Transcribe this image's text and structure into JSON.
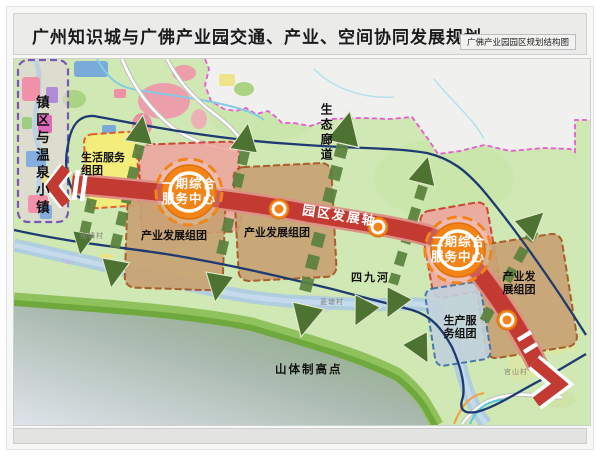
{
  "page": {
    "title": "广州知识城与广佛产业园交通、产业、空间协同发展规划",
    "subtitle": "广佛产业园园区规划结构图"
  },
  "map": {
    "town_zone_label": "镇区与温泉小镇",
    "life_cluster": {
      "line1": "生活服务",
      "line2": "组团"
    },
    "phase1_center": {
      "line1": "一期综合",
      "line2": "服务中心"
    },
    "phase2_center": {
      "line1": "二期综合",
      "line2": "服务中心"
    },
    "industry_cluster_1": "产业发展组团",
    "industry_cluster_2": "产业发展组团",
    "industry_cluster_3": {
      "line1": "产业发",
      "line2": "展组团"
    },
    "production_cluster": {
      "line1": "生产服",
      "line2": "务组团"
    },
    "axis_label": "园区发展轴",
    "eco_corridor_label": "生态廊道",
    "river_label": "四九河",
    "mountain_label": "山体制高点",
    "villages": {
      "v1": "细镇村",
      "v2": "菱塘村",
      "v3": "官山村"
    },
    "colors": {
      "axis_red": "#c23a32",
      "node_orange": "#f28418",
      "corridor_green": "#4d7231",
      "cluster_tan": "#c8a273",
      "life_yellow": "#f5ee78",
      "service_pink": "#efa39e",
      "production_blue": "#c2d2dc",
      "river_blue": "#a6c6e8",
      "road_navy": "#1e3a70",
      "boundary_magenta": "#ea5ad2",
      "town_boundary_purple": "#7a57b5",
      "mountain_edge_green": "#8fc25c"
    }
  }
}
